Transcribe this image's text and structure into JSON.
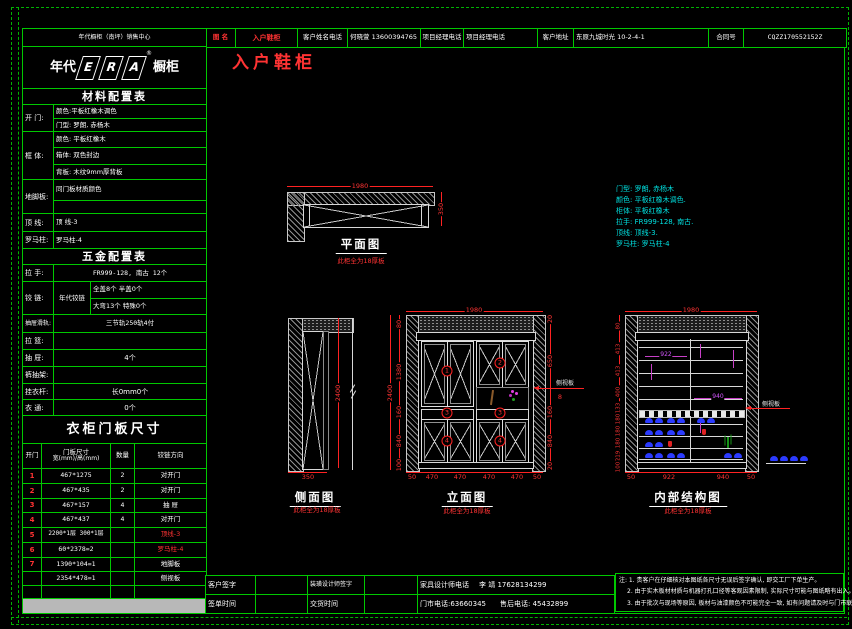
{
  "colors": {
    "line_green": "#00c800",
    "dim_red": "#ff2222",
    "note_cyan": "#00e0e0",
    "dim_purple": "#c840c8",
    "shoe_blue": "#2b3bff"
  },
  "top_bar": {
    "cells": [
      "图  名",
      "入户鞋柜",
      "客户姓名电话",
      "何晓萱 13600394765",
      "项目经理电话",
      "项目经理电话",
      "客户地址",
      "东原九城时光 10-2-4-1",
      "合同号",
      "CQZZ170552152Z"
    ]
  },
  "left_panel": {
    "dealer": "年代橱柜（南坪）销售中心",
    "logo": {
      "pre": "年代",
      "letters": [
        "E",
        "R",
        "A"
      ],
      "post": "橱柜",
      "reg": "®"
    },
    "material_table": {
      "title": "材料配置表",
      "groups": [
        {
          "label": "开  门:",
          "rows": [
            "颜色:平板红橡木调色",
            "门型: 罗朗, 赤杨木"
          ]
        },
        {
          "label": "框  体:",
          "rows": [
            "颜色: 平板红橡木",
            "箱体: 双色封边",
            "背板: 木纹9mm厚背板"
          ]
        },
        {
          "label": "地脚板:",
          "rows": [
            "同门板材质颜色",
            ""
          ]
        },
        {
          "label": "顶  线:",
          "rows": [
            "顶 线-3"
          ]
        },
        {
          "label": "罗马柱:",
          "rows": [
            "罗马柱-4"
          ]
        }
      ]
    },
    "hardware_table": {
      "title": "五金配置表",
      "rows": [
        {
          "label": "拉  手:",
          "value": "FR999-128, 南古 12个"
        },
        {
          "label": "铰  链:",
          "sub": "年代铰链",
          "line1": "全盖8个    半盖0个",
          "line2": "大弯13个   特殊0个"
        },
        {
          "label": "抽屉滑轨:",
          "value": "三节轨250轨4付"
        },
        {
          "label": "拉  篮:",
          "value": ""
        },
        {
          "label": "抽  屉:",
          "value": "4个"
        },
        {
          "label": "裤抽架:",
          "value": ""
        },
        {
          "label": "挂衣杆:",
          "value": "长0mm0个"
        },
        {
          "label": "衣  通:",
          "value": "0个"
        }
      ]
    },
    "door_table": {
      "title": "衣柜门板尺寸",
      "headers": {
        "col0": "开门",
        "col1a": "门板尺寸",
        "col1b": "宽(mm)/高(mm)",
        "col2": "数量",
        "col3": "铰链方向"
      },
      "rows": [
        [
          "1",
          "467*1275",
          "2",
          "对开门"
        ],
        [
          "2",
          "467*435",
          "2",
          "对开门"
        ],
        [
          "3",
          "467*157",
          "4",
          "抽  屉"
        ],
        [
          "4",
          "467*437",
          "4",
          "对开门"
        ],
        [
          "5",
          "2200*1层 300*1层",
          "",
          "顶线-3"
        ],
        [
          "6",
          "60*2378=2",
          "",
          "罗马柱-4"
        ],
        [
          "7",
          "1390*104=1",
          "",
          "地脚板"
        ],
        [
          "",
          "2354*478=1",
          "",
          "侧视板"
        ]
      ]
    }
  },
  "drawing": {
    "sheet_title": "入户鞋柜",
    "thickness_note": "此柜全为18厚板",
    "spec_notes": [
      "门型: 罗朗, 赤杨木",
      "颜色: 平板红橡木调色.",
      "柜体: 平板红橡木",
      "拉手: FR999-128, 南古.",
      "顶线: 顶线-3.",
      "罗马柱: 罗马柱-4"
    ],
    "plan": {
      "label": "平面图",
      "dim_width": "1980",
      "dim_depth": "350"
    },
    "side": {
      "label": "侧面图",
      "dim_height": "2400",
      "dim_depth": "350"
    },
    "elevation": {
      "label": "立面图",
      "dim_top": "1980",
      "dim_overall": "2400",
      "left_dims": [
        "80",
        "1380",
        "160",
        "840",
        "100"
      ],
      "right_dims": [
        "20",
        "650",
        "160",
        "840",
        "20"
      ],
      "side_panel": {
        "label": "侧视板",
        "value": "8"
      },
      "bottom_dims": [
        "50",
        "470",
        "470",
        "470",
        "470",
        "50"
      ],
      "marks": [
        "1",
        "2",
        "3",
        "3",
        "4",
        "4"
      ]
    },
    "internal": {
      "label": "内部结构图",
      "dim_top": "1980",
      "left_dims": [
        "80",
        "413",
        "413",
        "400",
        "133",
        "180",
        "180",
        "180",
        "219",
        "100"
      ],
      "shelf_dims": [
        "922",
        "940"
      ],
      "bottom_dims": [
        "50",
        "922",
        "940",
        "50"
      ],
      "side_panel_label": "侧视板"
    }
  },
  "footer": {
    "row1": [
      "客户签字",
      "",
      "装璜设计师签字",
      "",
      "家具设计师电话",
      "李 靖 17628134299"
    ],
    "row2": [
      "签单时间",
      "",
      "交货时间",
      "",
      "门市电话:63660345",
      "售后电话: 45432899"
    ],
    "notes": [
      "注: 1. 贵客户在仔细核对本图纸各尺寸无误后签字确认, 即交工厂下单生产。",
      "2. 由于实木板材材质与机器打孔口径等客观因素限制, 实际尺寸可能与图纸略有出入。",
      "3. 由于批次与现场等原因, 板材与油漆颜色不可能完全一致, 如有问题请及时与门市联系。"
    ]
  }
}
